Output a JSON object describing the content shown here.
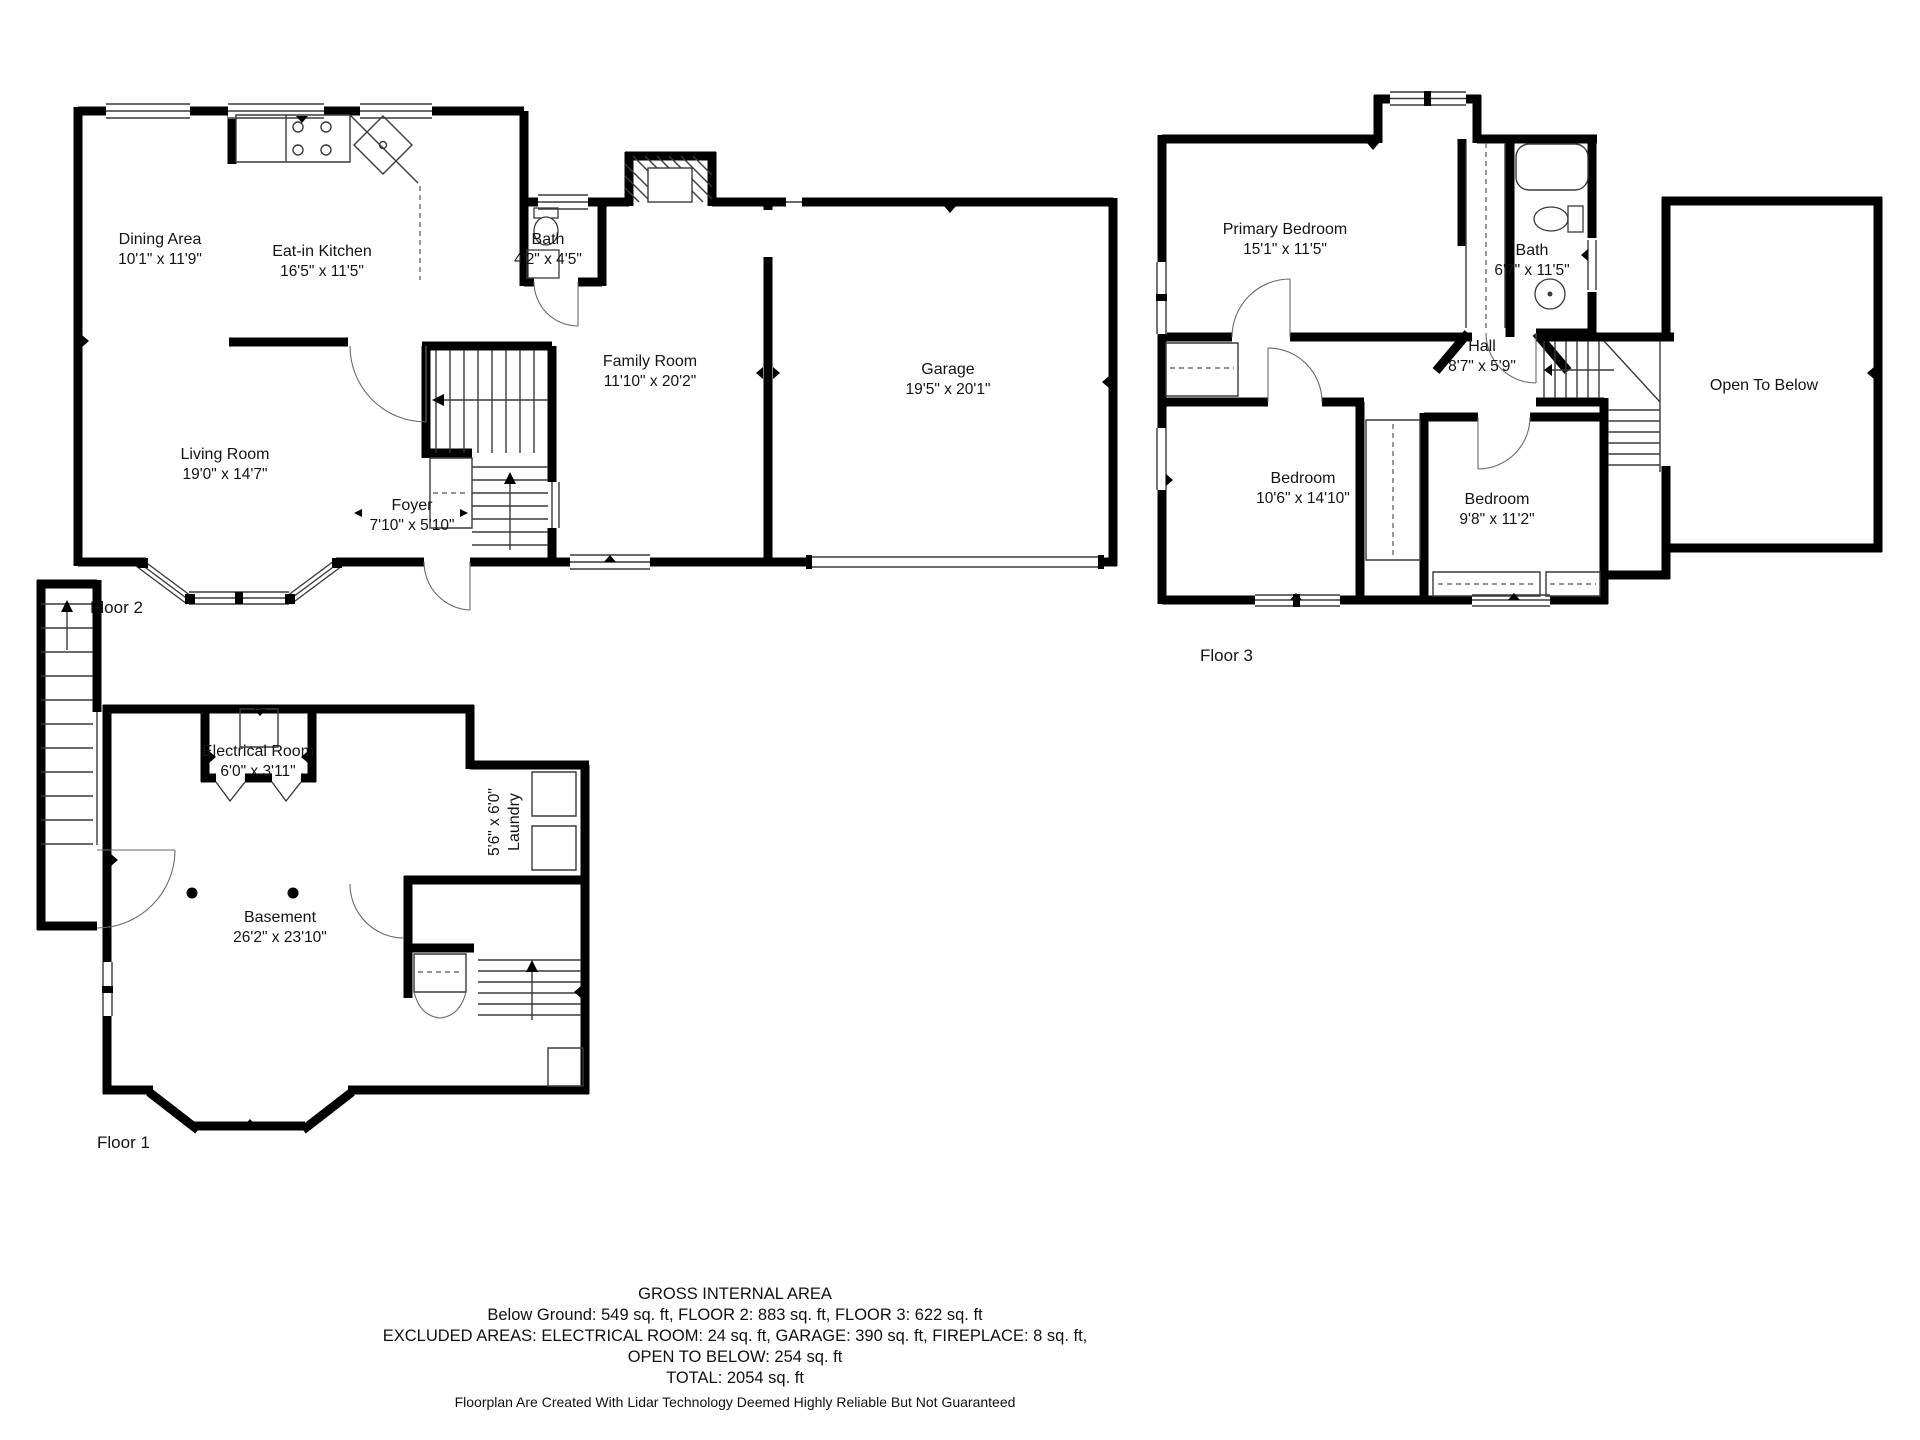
{
  "floors": [
    {
      "label": "Floor 2",
      "rooms": [
        {
          "name": "Dining Area",
          "dims": "10'1\" x 11'9\""
        },
        {
          "name": "Eat-in Kitchen",
          "dims": "16'5\" x 11'5\""
        },
        {
          "name": "Bath",
          "dims": "4'2\" x 4'5\""
        },
        {
          "name": "Family Room",
          "dims": "11'10\" x 20'2\""
        },
        {
          "name": "Garage",
          "dims": "19'5\" x 20'1\""
        },
        {
          "name": "Living Room",
          "dims": "19'0\" x 14'7\""
        },
        {
          "name": "Foyer",
          "dims": "7'10\" x 5'10\""
        }
      ]
    },
    {
      "label": "Floor 3",
      "rooms": [
        {
          "name": "Primary Bedroom",
          "dims": "15'1\" x 11'5\""
        },
        {
          "name": "Bath",
          "dims": "6'7\" x 11'5\""
        },
        {
          "name": "Hall",
          "dims": "8'7\" x 5'9\""
        },
        {
          "name": "Bedroom",
          "dims": "10'6\" x 14'10\""
        },
        {
          "name": "Bedroom",
          "dims": "9'8\" x 11'2\""
        },
        {
          "name": "Open To Below",
          "dims": ""
        }
      ]
    },
    {
      "label": "Floor 1",
      "rooms": [
        {
          "name": "Electrical Room",
          "dims": "6'0\" x 3'11\""
        },
        {
          "name": "Laundry",
          "dims": "5'6\" x 6'0\""
        },
        {
          "name": "Basement",
          "dims": "26'2\" x 23'10\""
        }
      ]
    }
  ],
  "footer": {
    "title": "GROSS INTERNAL AREA",
    "line1": "Below Ground: 549 sq. ft, FLOOR 2: 883 sq. ft, FLOOR 3: 622 sq. ft",
    "line2": "EXCLUDED AREAS: ELECTRICAL ROOM: 24 sq. ft, GARAGE: 390 sq. ft, FIREPLACE: 8 sq. ft,",
    "line3": "OPEN TO BELOW: 254 sq. ft",
    "line4": "TOTAL: 2054 sq. ft",
    "disclaimer": "Floorplan Are Created With Lidar Technology Deemed Highly Reliable But Not Guaranteed"
  }
}
